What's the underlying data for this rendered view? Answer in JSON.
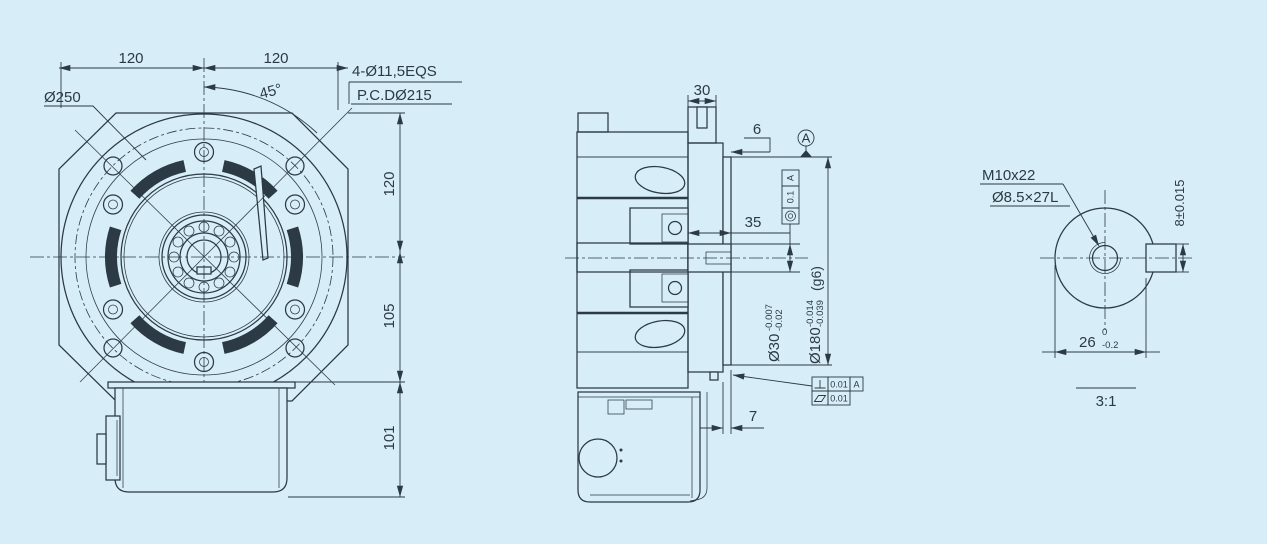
{
  "drawing": {
    "type": "mechanical engineering drawing - motor flange, section and shaft-end detail",
    "colors": {
      "background": "#d7edf7",
      "ink": "#2b3a45"
    },
    "front": {
      "dim_width_left": "120",
      "dim_width_right": "120",
      "dim_angle": "45°",
      "label_outer": "Ø250",
      "label_holes": "4-Ø11,5EQS",
      "label_pcd": "P.C.DØ215",
      "dim_v_top": "120",
      "dim_v_mid": "105",
      "dim_v_bot": "101"
    },
    "section": {
      "dim_top": "30",
      "dim_step": "6",
      "dim_flange": "35",
      "dim_spigot": "7",
      "shaft": {
        "dia": "Ø30",
        "tol_up": "-0.007",
        "tol_lo": "-0.02"
      },
      "spigot": {
        "dia": "Ø180",
        "tol_up": "-0.014",
        "tol_lo": "-0.039",
        "fit": "(g6)"
      },
      "datum": "A",
      "fcf_concentricity": {
        "symbol": "concentricity",
        "value": "0.1",
        "datum": "A"
      },
      "fcf_perpendicularity": {
        "symbol": "perpendicularity",
        "value": "0.01",
        "datum": "A"
      },
      "fcf_flatness": {
        "symbol": "flatness",
        "value": "0.01"
      }
    },
    "detail": {
      "label_thread": "M10x22",
      "label_hole": "Ø8.5×27L",
      "dim_key": "8±0.015",
      "dim_across": "26",
      "tol_up": "0",
      "tol_lo": "-0.2",
      "scale": "3:1"
    }
  }
}
